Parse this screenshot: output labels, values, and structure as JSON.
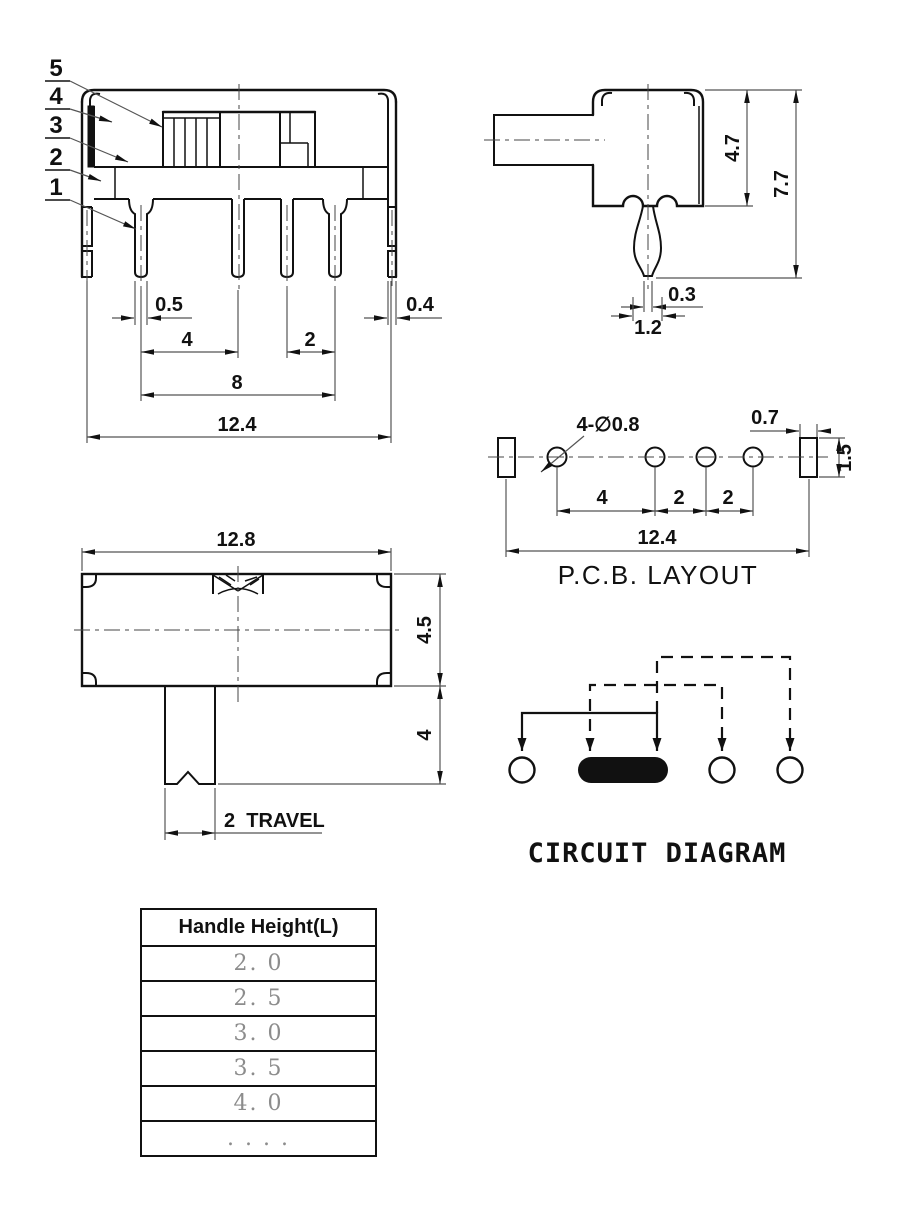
{
  "front_view": {
    "callouts": [
      "5",
      "4",
      "3",
      "2",
      "1"
    ],
    "dims": {
      "pin_width": "0.5",
      "leg_width": "0.4",
      "pitch_a": "4",
      "pitch_b": "2",
      "span": "8",
      "overall": "12.4"
    }
  },
  "side_view": {
    "dims": {
      "body_height": "4.7",
      "total_height": "7.7",
      "tip_width": "0.3",
      "pin_width": "1.2"
    }
  },
  "pcb_layout": {
    "title": "P.C.B. LAYOUT",
    "dims": {
      "holes": "4-∅0.8",
      "slot_width": "0.7",
      "slot_height": "1.5",
      "pitch_a": "4",
      "pitch_b": "2",
      "pitch_c": "2",
      "overall": "12.4"
    }
  },
  "top_view": {
    "dims": {
      "overall": "12.8",
      "body_depth": "4.5",
      "handle_length": "4",
      "travel": "2  TRAVEL"
    }
  },
  "circuit": {
    "title": "CIRCUIT DIAGRAM"
  },
  "handle_table": {
    "header": "Handle Height(L)",
    "rows": [
      "2. 0",
      "2. 5",
      "3. 0",
      "3. 5",
      "4. 0",
      ". . . ."
    ]
  }
}
